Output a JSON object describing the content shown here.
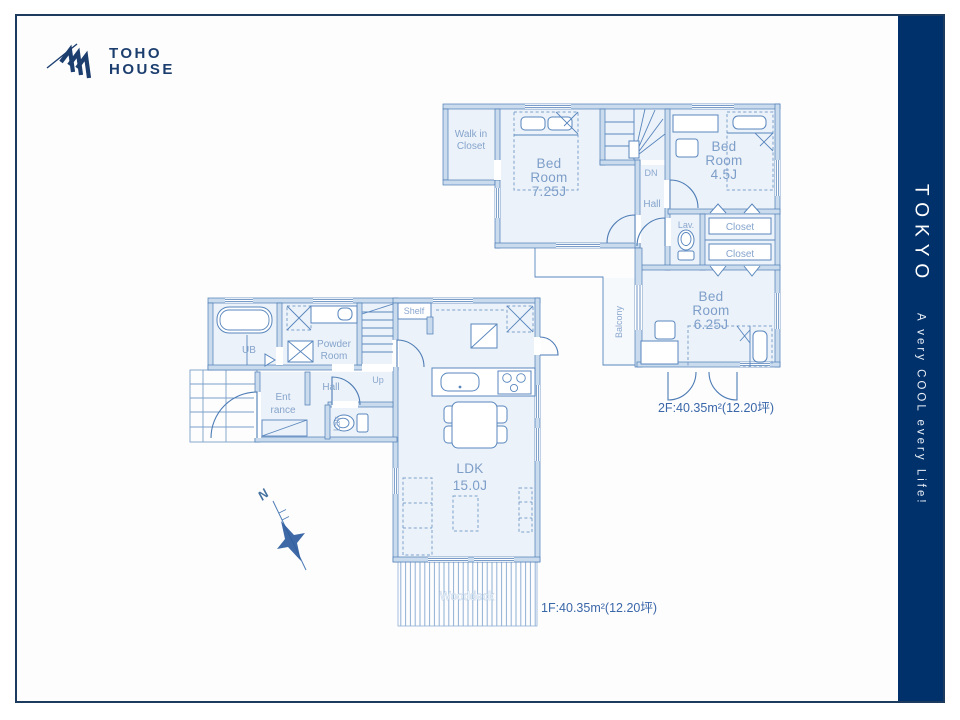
{
  "logo": {
    "line1": "TOHO",
    "line2": "HOUSE"
  },
  "sidebar": {
    "title": "TOKYO",
    "tagline": "A very COOL every Life!"
  },
  "compass": {
    "north": "N"
  },
  "colors": {
    "brand_navy": "#00316b",
    "plan_blue": "#4d7cb5",
    "label_blue": "#7d9ec9"
  },
  "floor2": {
    "area_label": "2F:40.35m²(12.20坪)",
    "walk_in_closet_line1": "Walk in",
    "walk_in_closet_line2": "Closet",
    "bedroom_main_line1": "Bed",
    "bedroom_main_line2": "Room",
    "bedroom_main_line3": "7.25J",
    "bedroom_small_line1": "Bed",
    "bedroom_small_line2": "Room",
    "bedroom_small_line3": "4.5J",
    "bedroom_mid_line1": "Bed",
    "bedroom_mid_line2": "Room",
    "bedroom_mid_line3": "6.25J",
    "down": "DN",
    "hall": "Hall",
    "lavatory": "Lav.",
    "closet_upper": "Closet",
    "closet_lower": "Closet",
    "balcony": "Balcony"
  },
  "floor1": {
    "area_label": "1F:40.35m²(12.20坪)",
    "unit_bath": "UB",
    "powder_line1": "Powder",
    "powder_line2": "Room",
    "entrance_line1": "Ent",
    "entrance_line2": "rance",
    "hall": "Hall",
    "lavatory": "Lav.",
    "up": "Up",
    "shelf": "Shelf",
    "ldk_line1": "LDK",
    "ldk_line2": "15.0J",
    "wooddeck": "Wooddeck"
  }
}
